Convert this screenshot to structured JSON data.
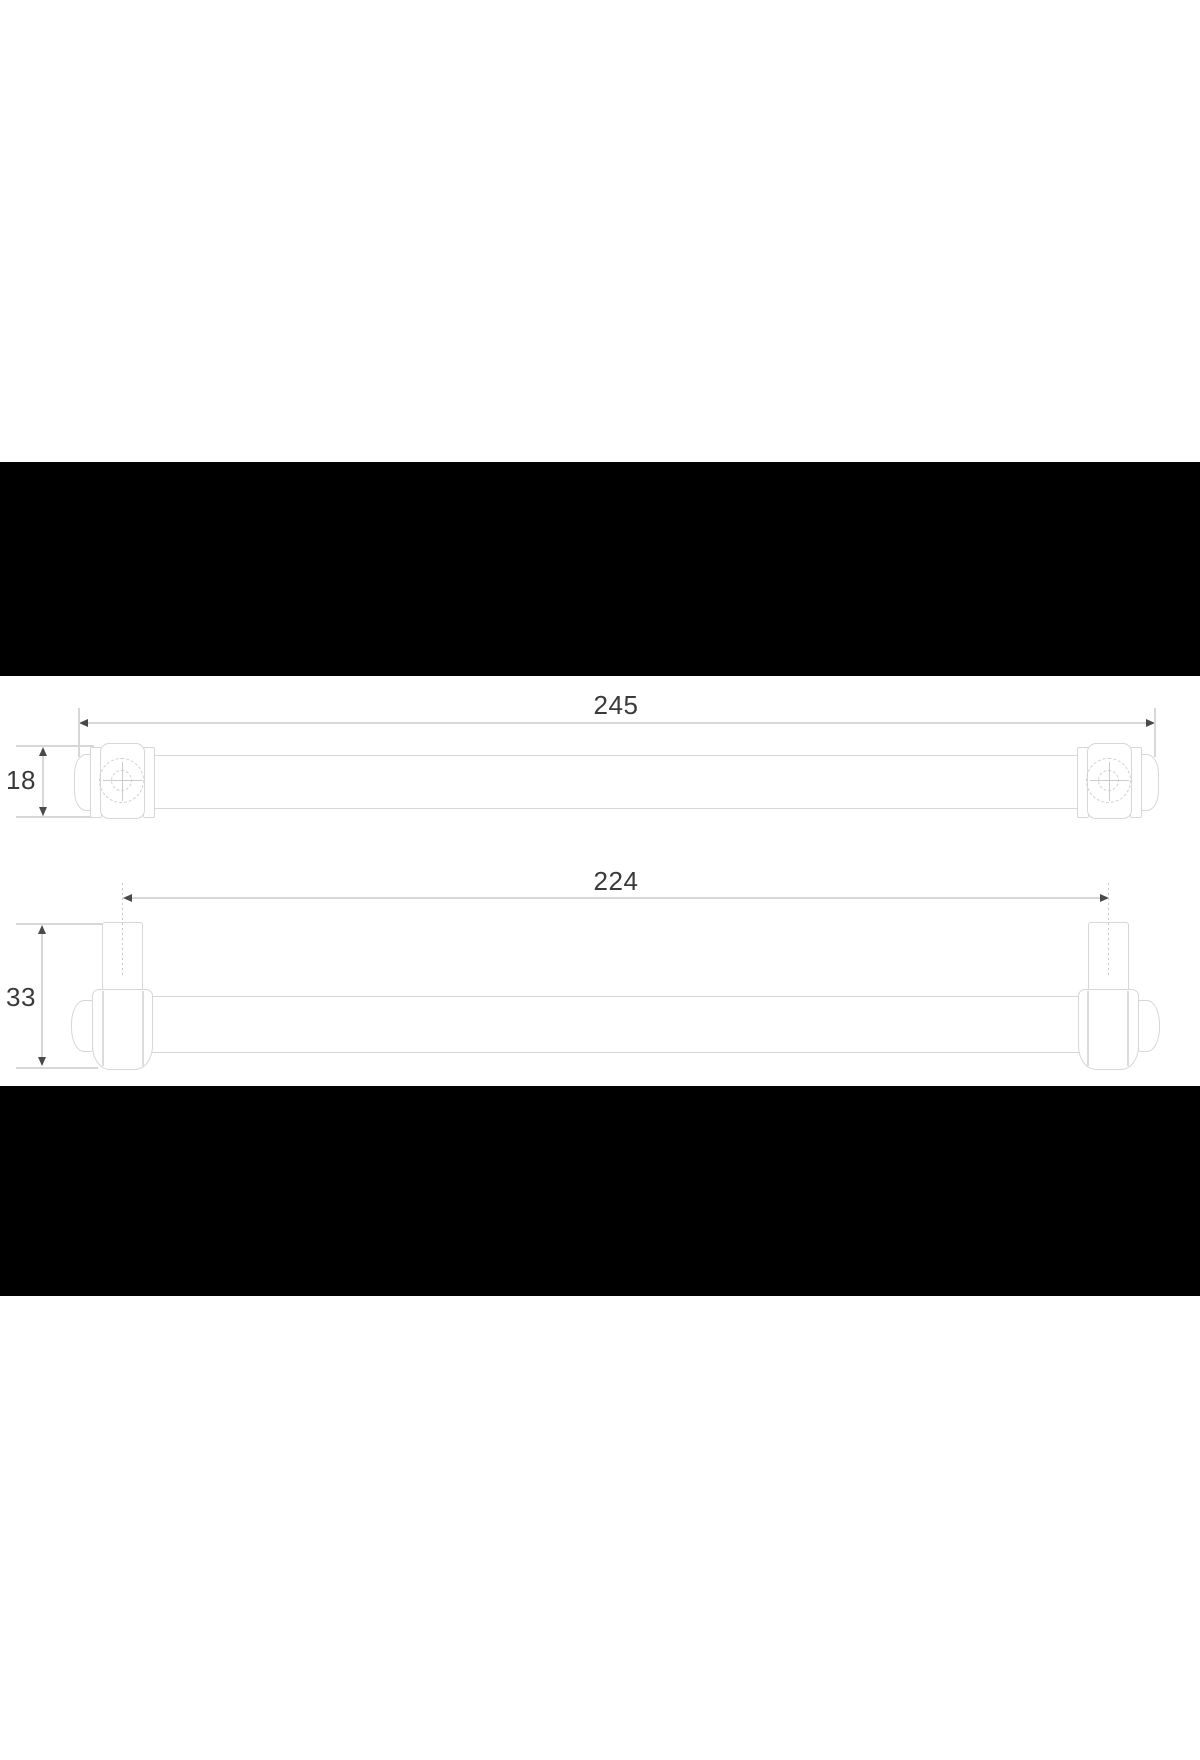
{
  "dims": {
    "overall_length": "245",
    "end_height": "18",
    "hole_centers": "224",
    "total_height": "33"
  },
  "colors": {
    "background": "#ffffff",
    "letterbox": "#000000",
    "drawing_line": "#d7d7d7",
    "dashed_detail_line": "#ccd0d3",
    "dimension_text": "#3a3a3a",
    "arrow": "#4a4a4a"
  }
}
